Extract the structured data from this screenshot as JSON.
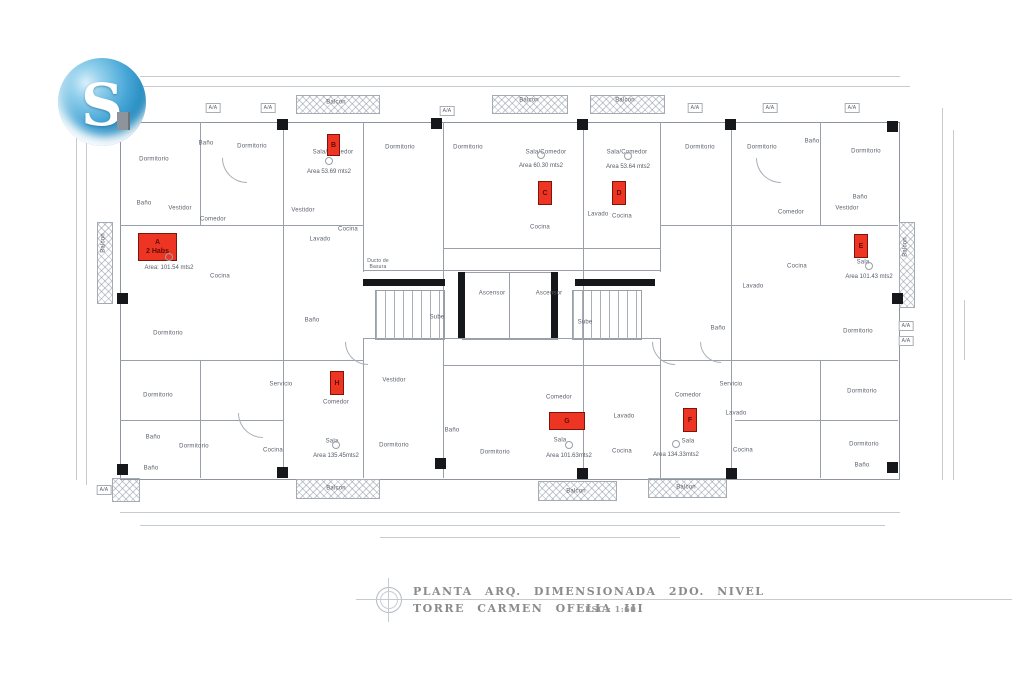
{
  "logo": {
    "letter": "S"
  },
  "title_block": {
    "line1": "PLANTA ARQ. DIMENSIONADA 2DO. NIVEL",
    "line2": "TORRE CARMEN OFELIA III",
    "scale": "ESC.: 1:60"
  },
  "units": [
    {
      "letter": "A",
      "tag": "2 Habs",
      "area": "Area: 101.54 mts2"
    },
    {
      "letter": "B",
      "tag": "",
      "area": "Area 53.69 mts2"
    },
    {
      "letter": "C",
      "tag": "",
      "area": "Area 60.30 mts2"
    },
    {
      "letter": "D",
      "tag": "",
      "area": "Area 53.64 mts2"
    },
    {
      "letter": "E",
      "tag": "",
      "area": "Area 101.43 mts2"
    },
    {
      "letter": "F",
      "tag": "",
      "area": "Area 134.33mts2"
    },
    {
      "letter": "G",
      "tag": "",
      "area": "Area 101.63mts2"
    },
    {
      "letter": "H",
      "tag": "",
      "area": "Area 135.45mts2"
    }
  ],
  "rooms": [
    "Dormitorio",
    "Dormitorio",
    "Baño",
    "Sala/Comedor",
    "Dormitorio",
    "Dormitorio",
    "Sala/Comedor",
    "Sala/Comedor",
    "Dormitorio",
    "Dormitorio",
    "Baño",
    "Dormitorio",
    "Baño",
    "Vestidor",
    "Comedor",
    "Vestidor",
    "Cocina",
    "Lavado",
    "Cocina",
    "Lavado",
    "Cocina",
    "Comedor",
    "Vestidor",
    "Baño",
    "Cocina",
    "Ducto de Basura",
    "Ascensor",
    "Ascensor",
    "Sube",
    "Sube",
    "Baño",
    "Baño",
    "Dormitorio",
    "Dormitorio",
    "Lavado",
    "Cocina",
    "Dormitorio",
    "Vestidor",
    "Comedor",
    "Sala",
    "Dormitorio",
    "Baño",
    "Dormitorio",
    "Baño",
    "Servicio",
    "Cocina",
    "Comedor",
    "Sala",
    "Lavado",
    "Cocina",
    "Comedor",
    "Servicio",
    "Lavado",
    "Sala",
    "Cocina",
    "Dormitorio",
    "Dormitorio",
    "Baño",
    "Dormitorio",
    "Baño",
    "Balcon",
    "Balcon",
    "Balcon",
    "Balcon",
    "Balcon",
    "Balcon",
    "Balcon",
    "Balcon",
    "A/A",
    "A/A",
    "A/A",
    "A/A",
    "A/A",
    "A/A",
    "A/A",
    "A/A",
    "A/A",
    "Sala"
  ],
  "colors": {
    "unit_marker_red": "#ee3524",
    "drawing_line_gray": "#99a0a9",
    "logo_blue": "#2f93c6"
  }
}
